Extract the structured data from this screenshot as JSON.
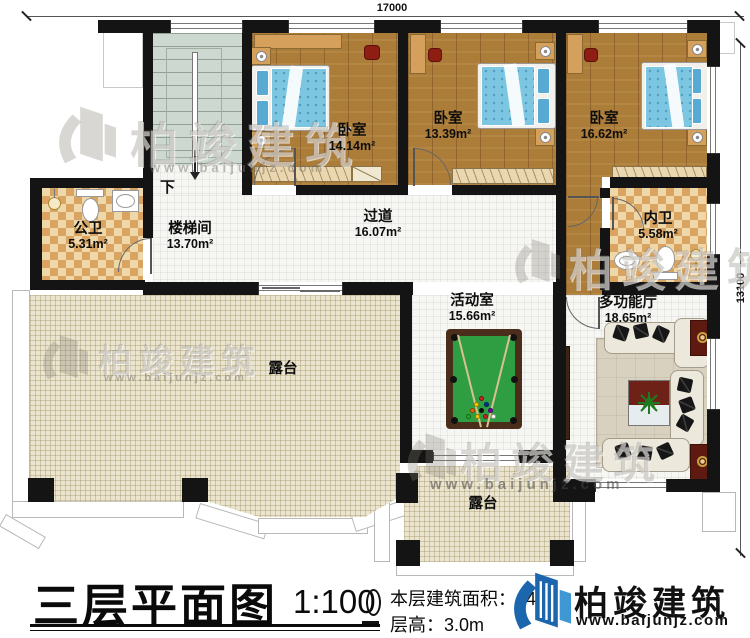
{
  "dimensions": {
    "top": "17000",
    "right": "13100"
  },
  "stairs": {
    "down": "下"
  },
  "rooms": [
    {
      "name": "公卫",
      "area": "5.31m²"
    },
    {
      "name": "楼梯间",
      "area": "13.70m²"
    },
    {
      "name": "卧室",
      "area": "14.14m²"
    },
    {
      "name": "卧室",
      "area": "13.39m²"
    },
    {
      "name": "卧室",
      "area": "16.62m²"
    },
    {
      "name": "内卫",
      "area": "5.58m²"
    },
    {
      "name": "过道",
      "area": "16.07m²"
    },
    {
      "name": "活动室",
      "area": "15.66m²"
    },
    {
      "name": "多功能厅",
      "area": "18.65m²"
    },
    {
      "name": "露台",
      "area": ""
    },
    {
      "name": "露台",
      "area": ""
    }
  ],
  "title": {
    "main": "三层平面图",
    "scale": "1:100"
  },
  "info": {
    "area_label": "本层建筑面积：",
    "area_value": "140",
    "height_label": "层高：",
    "height_value": "3.0m"
  },
  "branding": {
    "name": "柏竣建筑",
    "url": "www.baijunjz.com"
  },
  "watermark": {
    "text": "柏竣建筑",
    "url": "www.baijunjz.com"
  }
}
